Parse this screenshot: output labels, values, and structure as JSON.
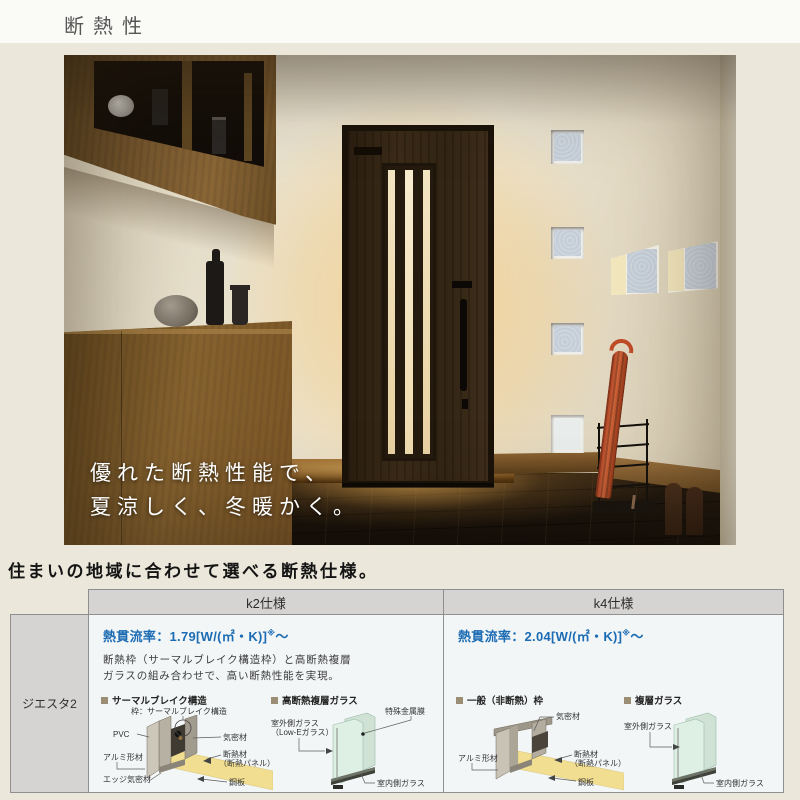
{
  "title": "断熱性",
  "hero": {
    "overlay_line1": "優れた断熱性能で、",
    "overlay_line2": "夏涼しく、冬暖かく。"
  },
  "section_heading": "住まいの地域に合わせて選べる断熱仕様。",
  "table": {
    "row_label": "ジエスタ2",
    "columns": [
      {
        "header": "k2仕様",
        "u_value_label": "熱貫流率：1.79[W/(㎡・K)]",
        "u_value_note": "※",
        "u_value_tail": "～",
        "description_line1": "断熱枠（サーマルブレイク構造枠）と高断熱複層",
        "description_line2": "ガラスの組み合わせで、高い断熱性能を実現。",
        "frame_diagram": {
          "title": "サーマルブレイク構造",
          "label_frame": "枠：サーマルブレイク構造",
          "label_pvc": "PVC",
          "label_airtight": "気密材",
          "label_aluminum": "アルミ形材",
          "label_insulation1": "断熱材",
          "label_insulation2": "（断熱パネル）",
          "label_edge": "エッジ気密材",
          "label_steel": "鋼板"
        },
        "glass_diagram": {
          "title": "高断熱複層ガラス",
          "label_film": "特殊金属膜",
          "label_outer1": "室外側ガラス",
          "label_outer2": "（Low-Eガラス）",
          "label_inner": "室内側ガラス"
        }
      },
      {
        "header": "k4仕様",
        "u_value_label": "熱貫流率：2.04[W/(㎡・K)]",
        "u_value_note": "※",
        "u_value_tail": "～",
        "frame_diagram": {
          "title": "一般（非断熱）枠",
          "label_airtight": "気密材",
          "label_aluminum": "アルミ形材",
          "label_insulation1": "断熱材",
          "label_insulation2": "（断熱パネル）",
          "label_steel": "鋼板"
        },
        "glass_diagram": {
          "title": "複層ガラス",
          "label_outer1": "室外側ガラス",
          "label_inner": "室内側ガラス"
        }
      }
    ]
  },
  "colors": {
    "accent_blue": "#1c6cb4",
    "table_header_bg": "#d5d4d2",
    "table_body_bg": "#f3f6f7",
    "page_bg": "#ebe7da",
    "insulation_yellow": "#f1de90",
    "glass_green": "#def0e4",
    "umbrella_red": "#c1502b",
    "door_wood": "#332514"
  }
}
